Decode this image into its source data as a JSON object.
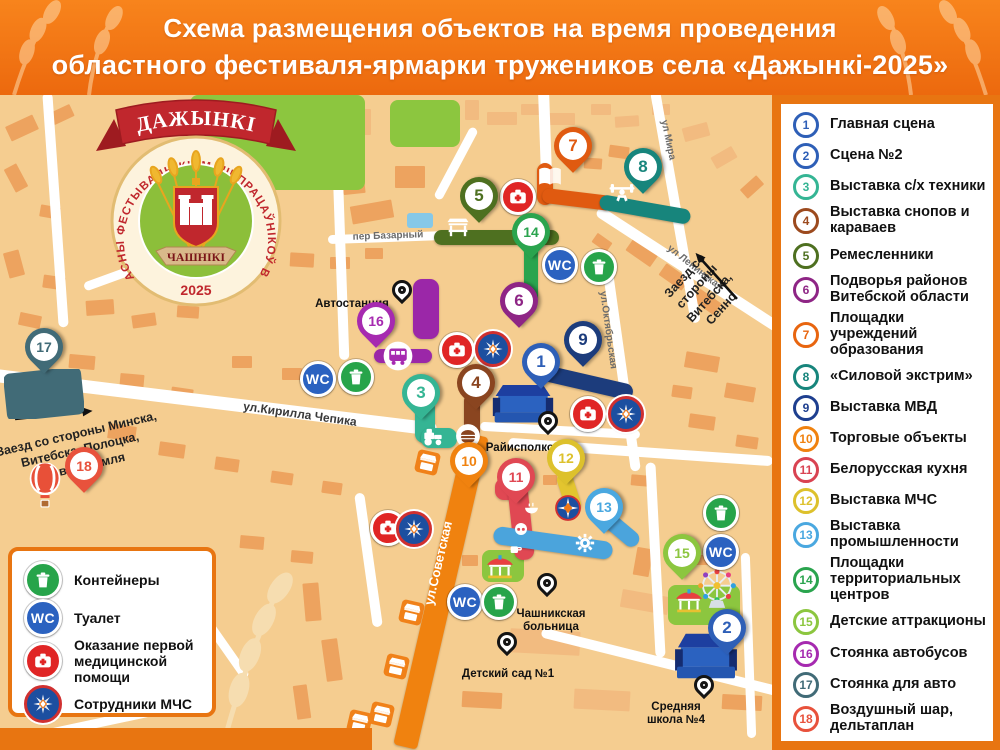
{
  "title": {
    "line1": "Схема размещения объектов на время проведения",
    "line2": "областного фестиваля-ярмарки тружеников села «Дажынкі-2025»"
  },
  "logo": {
    "banner": "ДАЖЫНКІ",
    "around": "АБЛАСНЫ ФЕСТЫВАЛЬ-КІРМАШ ПРАЦАЎНІКОЎ ВЁСКІ",
    "town": "ЧАШНІКІ",
    "year": "2025"
  },
  "colors": {
    "accent": "#e87511",
    "map_bg": "#f5cd90"
  },
  "services": {
    "wc_label": "WC"
  },
  "legend": {
    "items": [
      {
        "n": "1",
        "label": "Главная сцена",
        "color": "#2e5fb7"
      },
      {
        "n": "2",
        "label": "Сцена №2",
        "color": "#2e5fb7"
      },
      {
        "n": "3",
        "label": "Выставка с/х техники",
        "color": "#35b594"
      },
      {
        "n": "4",
        "label": "Выставка снопов и\nкараваев",
        "color": "#9c4a1e"
      },
      {
        "n": "5",
        "label": "Ремесленники",
        "color": "#4e7020"
      },
      {
        "n": "6",
        "label": "Подворья районов\nВитебской области",
        "color": "#8e2585"
      },
      {
        "n": "7",
        "label": "Площадки\nучреждений образования",
        "color": "#e8650f"
      },
      {
        "n": "8",
        "label": "«Силовой экстрим»",
        "color": "#17857c"
      },
      {
        "n": "9",
        "label": "Выставка МВД",
        "color": "#1e3f8f"
      },
      {
        "n": "10",
        "label": "Торговые объекты",
        "color": "#f0820f"
      },
      {
        "n": "11",
        "label": "Белорусская кухня",
        "color": "#d94352"
      },
      {
        "n": "12",
        "label": "Выставка МЧС",
        "color": "#ddc12c"
      },
      {
        "n": "13",
        "label": "Выставка\nпромышленности",
        "color": "#4aa8e0"
      },
      {
        "n": "14",
        "label": "Площадки\nтерриториальных центров",
        "color": "#2aa44e"
      },
      {
        "n": "15",
        "label": "Детские аттракционы",
        "color": "#8cc63f"
      },
      {
        "n": "16",
        "label": "Стоянка автобусов",
        "color": "#a62ab0"
      },
      {
        "n": "17",
        "label": "Стоянка для авто",
        "color": "#416b77"
      },
      {
        "n": "18",
        "label": "Воздушный шар,\nдельтаплан",
        "color": "#e8523c"
      }
    ]
  },
  "map_legend": {
    "items": [
      {
        "type": "trash",
        "label": "Контейнеры"
      },
      {
        "type": "wc",
        "label": "Туалет"
      },
      {
        "type": "med",
        "label": "Оказание первой\nмедицинской помощи"
      },
      {
        "type": "mchs",
        "label": "Сотрудники МЧС"
      }
    ]
  },
  "map": {
    "pins": [
      {
        "n": "1",
        "x": 541,
        "y": 362,
        "c": "#2e5fb7"
      },
      {
        "n": "2",
        "x": 727,
        "y": 628,
        "c": "#2e5fb7"
      },
      {
        "n": "3",
        "x": 421,
        "y": 393,
        "c": "#35b594"
      },
      {
        "n": "4",
        "x": 476,
        "y": 383,
        "c": "#8a4520"
      },
      {
        "n": "5",
        "x": 479,
        "y": 196,
        "c": "#4e7020"
      },
      {
        "n": "6",
        "x": 519,
        "y": 301,
        "c": "#8e2585"
      },
      {
        "n": "7",
        "x": 573,
        "y": 146,
        "c": "#e05a10"
      },
      {
        "n": "8",
        "x": 643,
        "y": 167,
        "c": "#17857c"
      },
      {
        "n": "9",
        "x": 583,
        "y": 340,
        "c": "#1c3c7c"
      },
      {
        "n": "10",
        "x": 469,
        "y": 461,
        "c": "#f0820f"
      },
      {
        "n": "11",
        "x": 516,
        "y": 477,
        "c": "#e04853"
      },
      {
        "n": "12",
        "x": 566,
        "y": 458,
        "c": "#ddc12c"
      },
      {
        "n": "13",
        "x": 604,
        "y": 507,
        "c": "#4aa8e0"
      },
      {
        "n": "14",
        "x": 531,
        "y": 232,
        "c": "#2aa44e"
      },
      {
        "n": "15",
        "x": 682,
        "y": 553,
        "c": "#8cc63f"
      },
      {
        "n": "16",
        "x": 376,
        "y": 321,
        "c": "#a62ab0"
      },
      {
        "n": "17",
        "x": 44,
        "y": 347,
        "c": "#416b77"
      },
      {
        "n": "18",
        "x": 84,
        "y": 466,
        "c": "#e8523c"
      }
    ],
    "place_pins": [
      {
        "label": "Автостанция",
        "px": 405,
        "py": 293,
        "lx": 352,
        "ly": 290
      },
      {
        "label": "Райисполком",
        "px": 551,
        "py": 424,
        "lx": 524,
        "ly": 434
      },
      {
        "label": "Чашникская\nбольница",
        "px": 550,
        "py": 586,
        "lx": 551,
        "ly": 600
      },
      {
        "label": "Детский сад №1",
        "px": 510,
        "py": 645,
        "lx": 508,
        "ly": 660
      },
      {
        "label": "Средняя\nшкола №4",
        "px": 707,
        "py": 688,
        "lx": 676,
        "ly": 693
      }
    ],
    "service_icons": [
      {
        "t": "wc",
        "x": 560,
        "y": 265
      },
      {
        "t": "wc",
        "x": 318,
        "y": 379
      },
      {
        "t": "wc",
        "x": 465,
        "y": 602
      },
      {
        "t": "wc",
        "x": 721,
        "y": 552
      },
      {
        "t": "trash",
        "x": 599,
        "y": 267
      },
      {
        "t": "trash",
        "x": 356,
        "y": 377
      },
      {
        "t": "trash",
        "x": 499,
        "y": 602
      },
      {
        "t": "trash",
        "x": 721,
        "y": 513
      },
      {
        "t": "med",
        "x": 518,
        "y": 197
      },
      {
        "t": "med",
        "x": 457,
        "y": 350
      },
      {
        "t": "med",
        "x": 588,
        "y": 414
      },
      {
        "t": "med",
        "x": 388,
        "y": 528
      },
      {
        "t": "mchs",
        "x": 493,
        "y": 349
      },
      {
        "t": "mchs",
        "x": 626,
        "y": 414
      },
      {
        "t": "mchs",
        "x": 414,
        "y": 529
      }
    ],
    "segments": [
      [
        496,
        237,
        125,
        15,
        0,
        "#4e7020"
      ],
      [
        531,
        271,
        14,
        64,
        0,
        "#2aa44e"
      ],
      [
        545,
        184,
        16,
        42,
        0,
        "#e05a10"
      ],
      [
        578,
        199,
        72,
        15,
        7,
        "#e05a10"
      ],
      [
        645,
        209,
        92,
        15,
        10,
        "#17857c"
      ],
      [
        584,
        382,
        100,
        16,
        13,
        "#1c3c7c"
      ],
      [
        426,
        309,
        26,
        60,
        0,
        "#9b27a8"
      ],
      [
        403,
        356,
        58,
        14,
        0,
        "#9b27a8"
      ],
      [
        425,
        421,
        20,
        44,
        0,
        "#35b594"
      ],
      [
        439,
        438,
        36,
        20,
        0,
        "#35b594"
      ],
      [
        472,
        418,
        16,
        50,
        0,
        "#8a4520"
      ],
      [
        509,
        489,
        28,
        22,
        0,
        "#e04853"
      ],
      [
        521,
        521,
        20,
        78,
        -6,
        "#e04853"
      ],
      [
        569,
        492,
        16,
        42,
        -18,
        "#e3c52f"
      ],
      [
        553,
        543,
        120,
        18,
        8,
        "#4ba4dc"
      ],
      [
        622,
        531,
        40,
        16,
        40,
        "#4ba4dc"
      ]
    ],
    "route_icons": [
      [
        "book",
        550,
        177
      ],
      [
        "lifter",
        622,
        194
      ],
      [
        "craft",
        458,
        228
      ],
      [
        "tractor",
        433,
        437
      ],
      [
        "bread",
        468,
        436
      ],
      [
        "bus",
        398,
        356
      ],
      [
        "gear",
        585,
        543
      ],
      [
        "mchsbadge",
        568,
        508
      ],
      [
        "snow",
        513,
        489
      ],
      [
        "bowl",
        531,
        508
      ],
      [
        "pretzel",
        521,
        529
      ],
      [
        "cup",
        516,
        549
      ],
      [
        "carousel",
        500,
        567
      ],
      [
        "carousel",
        689,
        601
      ],
      [
        "ferris",
        717,
        588
      ],
      [
        "balloon",
        45,
        486
      ],
      [
        "car",
        42,
        395
      ],
      [
        "stall",
        427,
        462
      ],
      [
        "stall",
        411,
        612
      ],
      [
        "stall",
        396,
        666
      ],
      [
        "stall",
        381,
        714
      ],
      [
        "stall",
        359,
        722
      ],
      [
        "stage",
        523,
        406
      ],
      [
        "stage2",
        706,
        657
      ],
      [
        "parking",
        44,
        394
      ]
    ],
    "street_labels": [
      {
        "text": "пер Базарный",
        "x": 388,
        "y": 236,
        "a": -2,
        "c": "#6b6b6b",
        "fs": 10
      },
      {
        "text": "ул.Кирилла Чепика",
        "x": 300,
        "y": 414,
        "a": 8,
        "c": "#3a3a3a",
        "fs": 12
      },
      {
        "text": "ул.Советская",
        "x": 438,
        "y": 563,
        "a": -77,
        "c": "#ffffff",
        "fs": 13
      },
      {
        "text": "ул Мира",
        "x": 668,
        "y": 140,
        "a": 78,
        "c": "#6b6b6b",
        "fs": 10
      },
      {
        "text": "ул Ленинская",
        "x": 695,
        "y": 268,
        "a": 38,
        "c": "#6b6b6b",
        "fs": 10
      },
      {
        "text": "ул.Октябрьская",
        "x": 608,
        "y": 330,
        "a": 82,
        "c": "#6b6b6b",
        "fs": 10
      }
    ],
    "notes": [
      {
        "text": "Заезд со стороны Минска,\nВитебска, Полоцка,\nНоволукомля",
        "x": 80,
        "y": 450,
        "a": -13
      },
      {
        "text": "Заезд со стороны\nВитебска, Сенно",
        "x": 703,
        "y": 292,
        "a": -48
      }
    ],
    "arrows": [
      {
        "x": 15,
        "y": 419,
        "len": 78,
        "a": -6
      },
      {
        "x": 737,
        "y": 299,
        "len": 62,
        "a": -132
      }
    ]
  }
}
